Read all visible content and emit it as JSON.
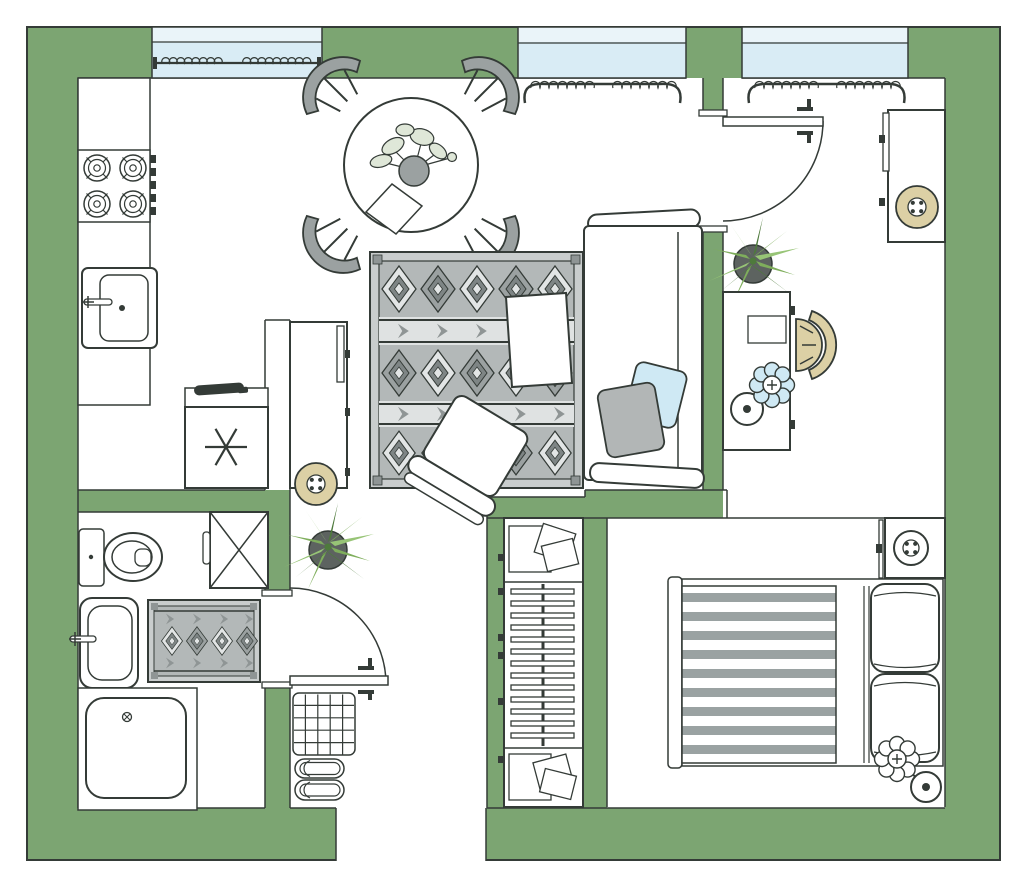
{
  "document": {
    "type": "apartment-floor-plan",
    "view": "top-down",
    "window_count": 3,
    "door_count": 2,
    "room_count": 6
  },
  "palette": {
    "paper_white": "#ffffff",
    "wall_green": "#7ca572",
    "line_dark": "#343b37",
    "window_blue": "#d9ecf5",
    "window_blue_pale": "#eaf4f9",
    "beige": "#dcd0a5",
    "gray_mid": "#9ba1a1",
    "gray_dark": "#7e8585",
    "gray_light": "#e2e5e5",
    "rug_bg": "#b3b8b8",
    "rug_frame": "#c9cdcd",
    "pillow_blue": "#cfe9f4",
    "pillow_gray": "#b2b6b6",
    "duvet_stripe": "#9aa2a2",
    "plant_green": "#7fae5c",
    "plant_green_light": "#97c476",
    "plant_green_dark": "#4e7a3c",
    "pot_gray": "#5d6360"
  },
  "rooms": [
    {
      "id": "kitchen",
      "furniture": [
        "counter",
        "stove-4-burner",
        "kitchen-sink",
        "coffee-maker",
        "refrigerator"
      ]
    },
    {
      "id": "living-room",
      "furniture": [
        "dining-table",
        "dining-chair x4",
        "table-plant",
        "napkin",
        "area-rug",
        "coffee-table",
        "armchair",
        "sofa",
        "pillow-blue",
        "pillow-gray",
        "console-cabinet",
        "stool",
        "floor-plant"
      ]
    },
    {
      "id": "entry-study",
      "furniture": [
        "entry-door",
        "desk",
        "desk-chair",
        "flower-floor-lamp",
        "cabinet",
        "stool",
        "floor-plant"
      ]
    },
    {
      "id": "bedroom",
      "furniture": [
        "double-bed-striped-duvet",
        "pillow x2",
        "nightstand",
        "round-lamp",
        "flower-floor-lamp"
      ]
    },
    {
      "id": "bathroom",
      "furniture": [
        "toilet",
        "washing-machine",
        "bath-mat",
        "bathroom-sink",
        "shower"
      ]
    },
    {
      "id": "hallway",
      "furniture": [
        "interior-door",
        "wardrobe-closet",
        "doormat",
        "slippers x2-pairs"
      ]
    }
  ]
}
